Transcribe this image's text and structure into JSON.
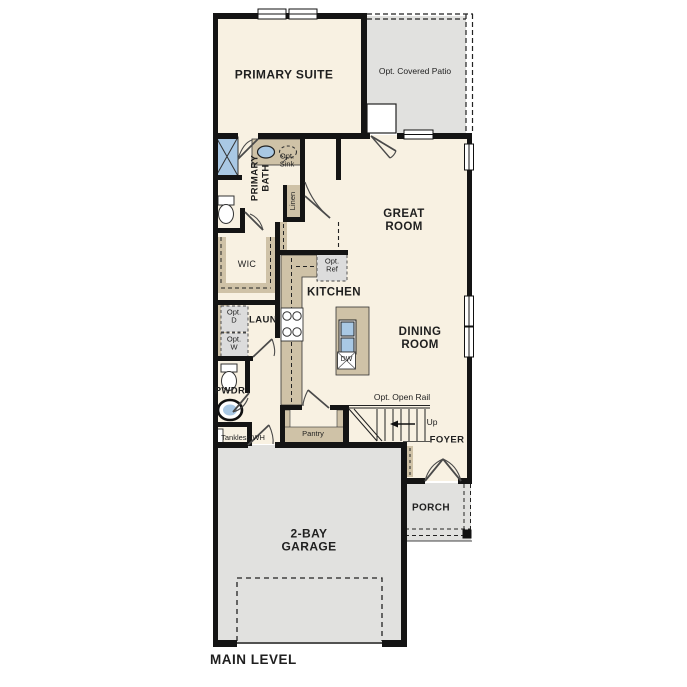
{
  "plan_title": "MAIN LEVEL",
  "rooms": {
    "primary_suite": "PRIMARY SUITE",
    "primary_bath": "PRIMARY BATH",
    "wic": "WIC",
    "laundry": "LAUN",
    "powder": "PWDR",
    "kitchen": "KITCHEN",
    "great_room": "GREAT ROOM",
    "dining_room": "DINING ROOM",
    "foyer": "FOYER",
    "porch": "PORCH",
    "garage": "2-BAY GARAGE",
    "pantry": "Pantry",
    "linen": "Linen",
    "patio": "Opt. Covered Patio"
  },
  "annotations": {
    "opt_sink": "Opt. Sink",
    "opt_ref": "Opt. Ref",
    "opt_dryer": "Opt. D",
    "opt_washer": "Opt. W",
    "tankless_wh": "Tankless WH",
    "opt_open_rail": "Opt. Open Rail",
    "up": "Up",
    "dishwasher": "DW"
  },
  "colors": {
    "floor": "#f8f1e2",
    "exterior_floor": "#e1e1df",
    "counter": "#cfc2a7",
    "fixture_blue": "#a9c8e4",
    "wall": "#141414"
  }
}
